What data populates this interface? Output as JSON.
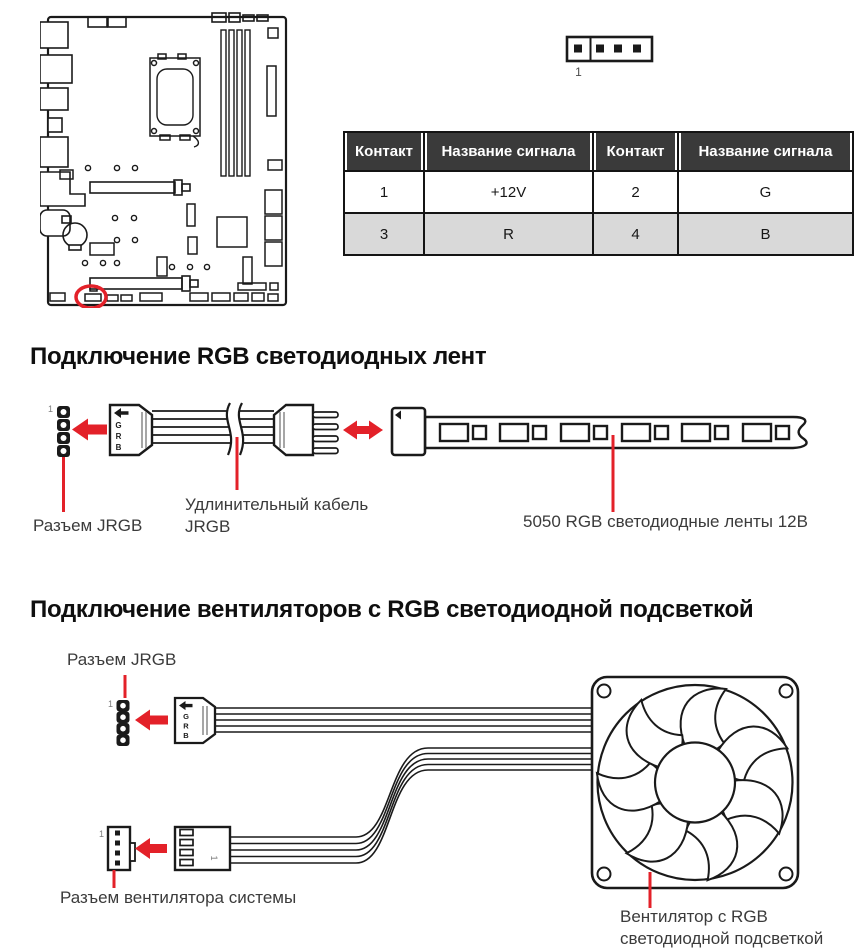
{
  "headings": {
    "rgb_strips": "Подключение RGB светодиодных лент",
    "rgb_fans": "Подключение вентиляторов с RGB светодиодной подсветкой"
  },
  "pin_table": {
    "headers": [
      "Контакт",
      "Название сигнала",
      "Контакт",
      "Название сигнала"
    ],
    "rows": [
      [
        "1",
        "+12V",
        "2",
        "G"
      ],
      [
        "3",
        "R",
        "4",
        "B"
      ]
    ]
  },
  "labels": {
    "pin1": "1",
    "jrgb_connector": "Разъем JRGB",
    "extension_cable": "Удлинительный кабель\nJRGB",
    "led_strip": "5050 RGB светодиодные ленты 12В",
    "system_fan_connector": "Разъем вентилятора системы",
    "rgb_fan": "Вентилятор с RGB\nсветодиодной подсветкой"
  },
  "connector_letters": [
    "G",
    "R",
    "B"
  ],
  "colors": {
    "accent_red": "#e32129",
    "line_art": "#1a1a1a",
    "table_header_bg": "#3a3a3a",
    "row_alt_bg": "#d9d9d9"
  }
}
